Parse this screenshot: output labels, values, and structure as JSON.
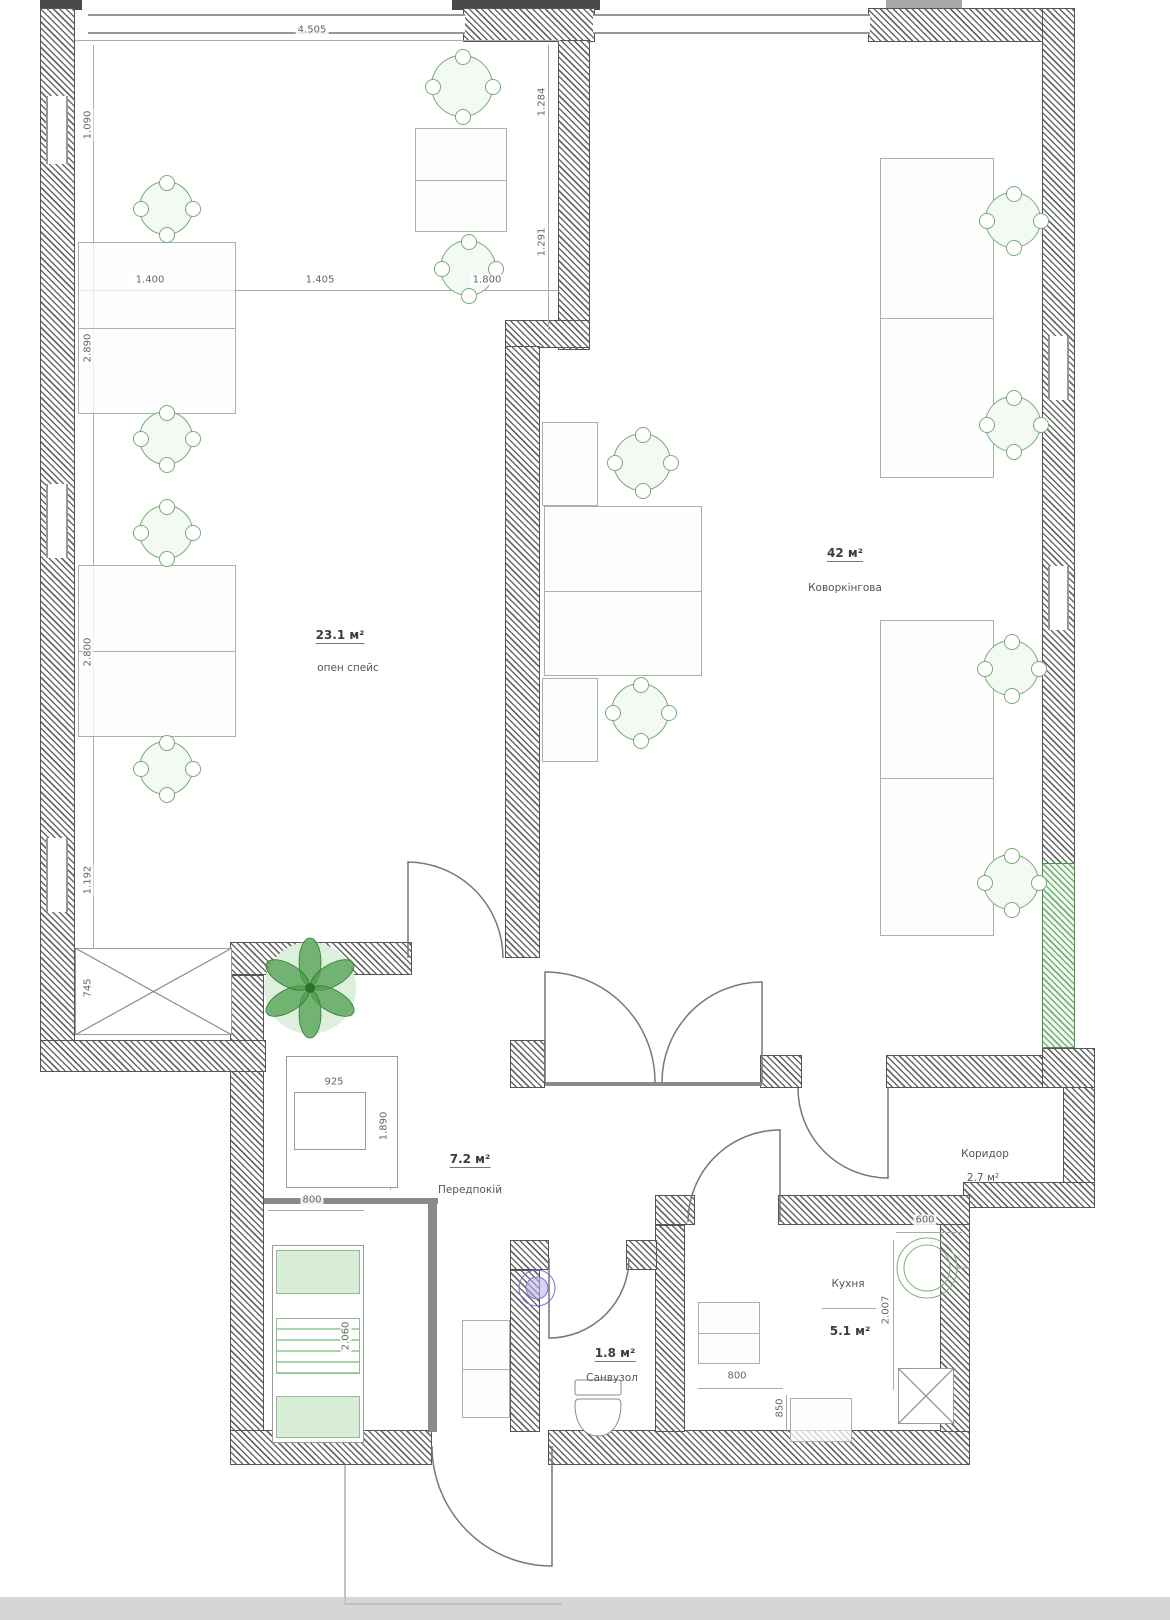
{
  "plan_title": "office floor plan",
  "colors": {
    "wall": "#5a5a5a",
    "wall_green": "#74b274",
    "furniture": "#a3b6a3",
    "chair": "#76ab76",
    "plant": "#4e9e4e",
    "sink_purple": "#8273cf",
    "dim_text": "#666666",
    "bottom_bar": "#d6d6d6"
  },
  "rooms": [
    {
      "id": "open-space",
      "area": "23.1 м²",
      "name": "опен спейс"
    },
    {
      "id": "coworking",
      "area": "42 м²",
      "name": "Коворкінгова"
    },
    {
      "id": "hall",
      "area": "7.2 м²",
      "name": "Передпокій"
    },
    {
      "id": "bathroom",
      "area": "1.8 м²",
      "name": "Санвузол"
    },
    {
      "id": "kitchen",
      "area": "5.1 м²",
      "name": "Кухня"
    },
    {
      "id": "corridor",
      "area": "2.7 м²",
      "name": "Коридор"
    }
  ],
  "dims": {
    "top_width": "4.505",
    "desk_w1": "1.400",
    "desk_w2": "1.405",
    "desk_w3": "1.800",
    "left_v1": "1.090",
    "left_v2": "2.890",
    "left_v3": "2.800",
    "left_v4": "1.192",
    "left_v5": "745",
    "bay_v1": "1.284",
    "bay_v2": "1.291",
    "closet_w": "925",
    "closet_h": "1.890",
    "storage_w": "800",
    "storage_h": "2.060",
    "kitchen_w": "800",
    "kitchen_h": "850",
    "sink_w": "600",
    "kright_h": "2.007"
  }
}
